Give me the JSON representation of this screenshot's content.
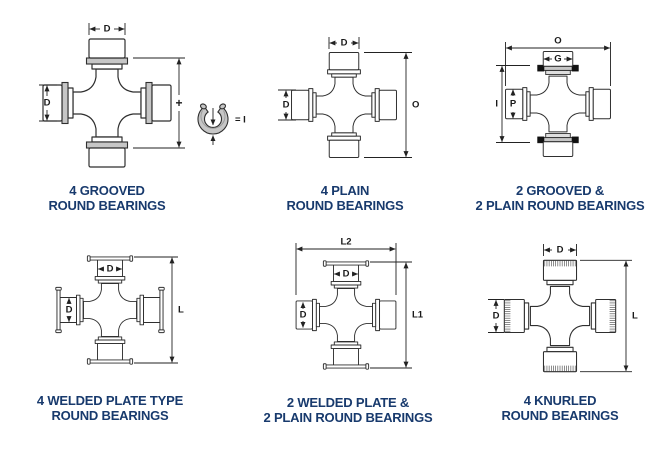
{
  "colors": {
    "caption_text": "#183a6d",
    "drawing_line": "#2f2f2f",
    "groove_gray": "#c6c6c6",
    "snap_ring_black": "#111111"
  },
  "diagrams": [
    {
      "type": "4-grooved-round-bearings",
      "caption": [
        "4 GROOVED",
        "ROUND BEARINGS"
      ],
      "dims": {
        "top": "D",
        "left": "D",
        "plus": "+",
        "ring_equals": "= I"
      }
    },
    {
      "type": "4-plain-round-bearings",
      "caption": [
        "4 PLAIN",
        "ROUND BEARINGS"
      ],
      "dims": {
        "top": "D",
        "left": "D",
        "right": "O"
      }
    },
    {
      "type": "2-grooved-2-plain-round-bearings",
      "caption": [
        "2 GROOVED &",
        "2 PLAIN ROUND BEARINGS"
      ],
      "dims": {
        "top": "O",
        "cap_top": "G",
        "left": "I",
        "cap_left": "P"
      }
    },
    {
      "type": "4-welded-plate-type-round-bearings",
      "caption": [
        "4 WELDED PLATE TYPE",
        "ROUND BEARINGS"
      ],
      "dims": {
        "cap_top": "D",
        "cap_left": "D",
        "right": "L"
      }
    },
    {
      "type": "2-welded-plate-2-plain-round-bearings",
      "caption": [
        "2 WELDED PLATE &",
        "2 PLAIN ROUND BEARINGS"
      ],
      "dims": {
        "top": "L2",
        "cap_top": "D",
        "cap_left": "D",
        "right": "L1"
      }
    },
    {
      "type": "4-knurled-round-bearings",
      "caption": [
        "4 KNURLED",
        "ROUND BEARINGS"
      ],
      "dims": {
        "top": "D",
        "left": "D",
        "right": "L"
      }
    }
  ]
}
